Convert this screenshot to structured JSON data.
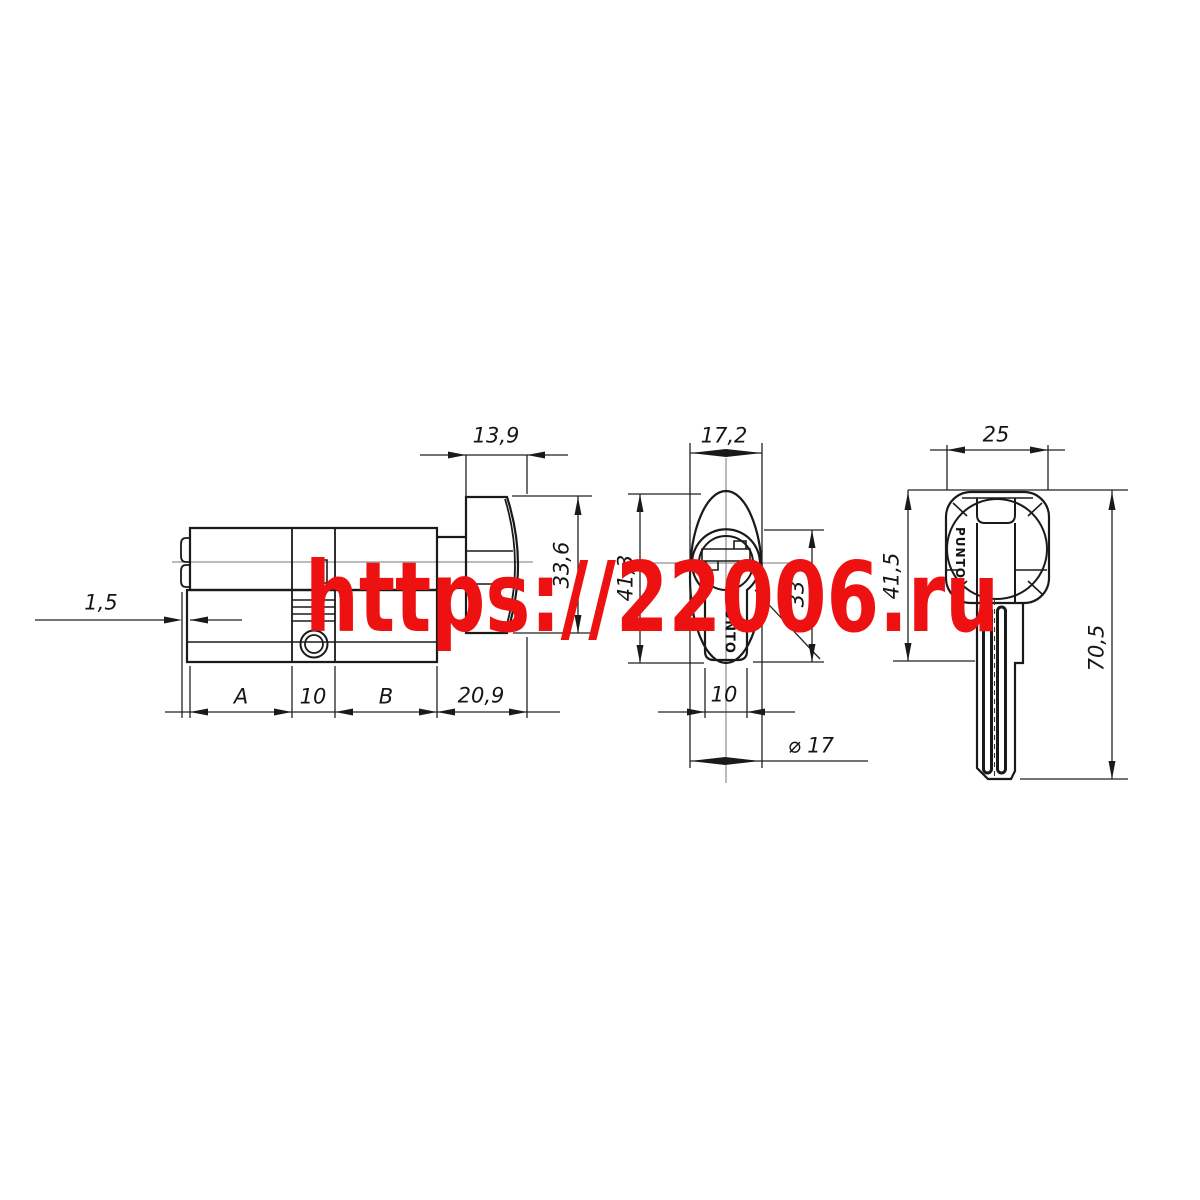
{
  "watermark": {
    "text": "https://22006.ru",
    "color": "#ee1111"
  },
  "drawing": {
    "line_color": "#1a1a1a",
    "side_view": {
      "dims": {
        "knob_width": "13,9",
        "knob_height": "33,6",
        "plug_protrusion": "1,5",
        "section_a": "A",
        "cam_width": "10",
        "section_b": "B",
        "knob_length": "20,9"
      }
    },
    "front_view": {
      "brand": "PUNTO",
      "dims": {
        "knob_face_width": "17,2",
        "total_height": "41,3",
        "body_height": "33",
        "stem_width": "10",
        "plug_diameter": "⌀ 17"
      }
    },
    "key_view": {
      "brand": "PUNTO",
      "dims": {
        "head_width": "25",
        "head_height": "41,5",
        "total_length": "70,5"
      }
    }
  }
}
